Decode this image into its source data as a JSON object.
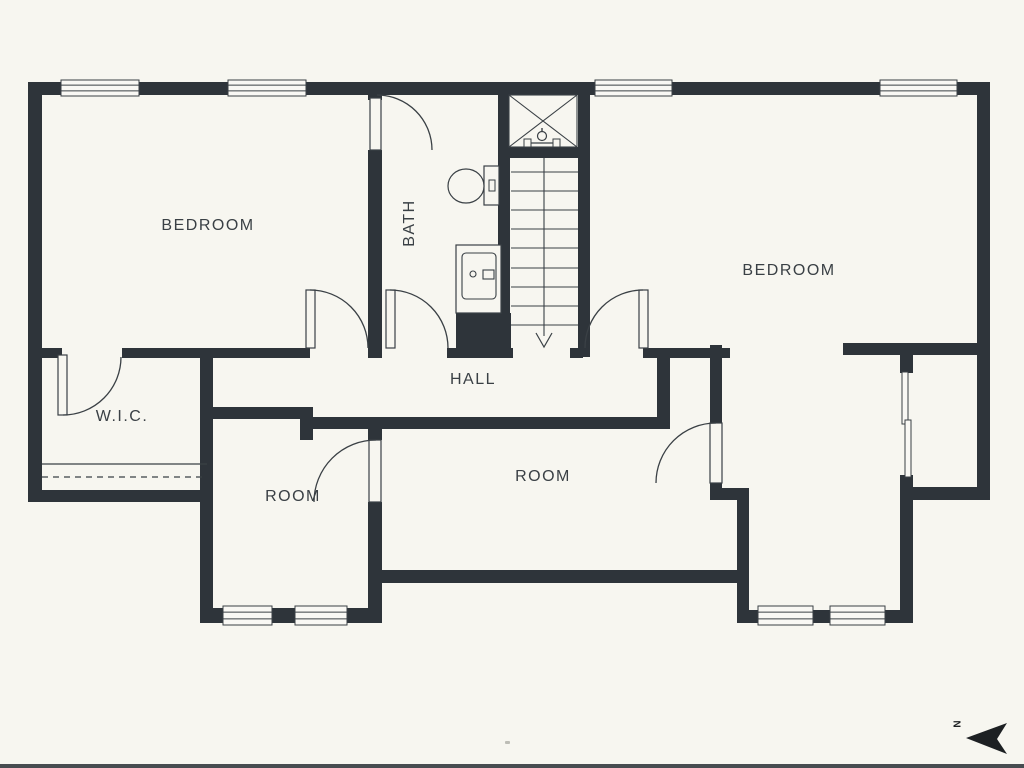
{
  "title": "Floor plan - upper level",
  "colors": {
    "background": "#f7f6f0",
    "wall": "#2e343a",
    "line": "#3a4045",
    "white": "#f9f8f4",
    "arrow": "#1d2023"
  },
  "labels": [
    {
      "text": "BEDROOM",
      "x": 208,
      "y": 226,
      "rotate": 0
    },
    {
      "text": "BATH",
      "x": 410,
      "y": 223,
      "rotate": -90
    },
    {
      "text": "BEDROOM",
      "x": 789,
      "y": 271,
      "rotate": 0
    },
    {
      "text": "W.I.C.",
      "x": 122,
      "y": 417,
      "rotate": 0
    },
    {
      "text": "HALL",
      "x": 473,
      "y": 380,
      "rotate": 0
    },
    {
      "text": "ROOM",
      "x": 293,
      "y": 497,
      "rotate": 0
    },
    {
      "text": "ROOM",
      "x": 543,
      "y": 477,
      "rotate": 0
    }
  ],
  "north": {
    "label": "N",
    "points": "966,738 1007,723 997,739 1007,754",
    "label_x": 958,
    "label_y": 724
  },
  "walls": [
    [
      28,
      82,
      962,
      13
    ],
    [
      28,
      82,
      14,
      420
    ],
    [
      28,
      490,
      185,
      12
    ],
    [
      977,
      82,
      13,
      418
    ],
    [
      903,
      487,
      87,
      13
    ],
    [
      42,
      348,
      20,
      10
    ],
    [
      122,
      348,
      188,
      10
    ],
    [
      447,
      348,
      66,
      10
    ],
    [
      570,
      348,
      13,
      10
    ],
    [
      643,
      348,
      87,
      10
    ],
    [
      843,
      343,
      147,
      12
    ],
    [
      368,
      92,
      14,
      8
    ],
    [
      368,
      150,
      14,
      208
    ],
    [
      498,
      92,
      12,
      265
    ],
    [
      498,
      147,
      92,
      11
    ],
    [
      578,
      95,
      12,
      262
    ],
    [
      456,
      313,
      57,
      44
    ],
    [
      200,
      348,
      13,
      275
    ],
    [
      213,
      407,
      100,
      12
    ],
    [
      300,
      407,
      13,
      33
    ],
    [
      300,
      417,
      370,
      12
    ],
    [
      657,
      348,
      13,
      81
    ],
    [
      368,
      427,
      14,
      13
    ],
    [
      368,
      502,
      14,
      121
    ],
    [
      200,
      608,
      182,
      15
    ],
    [
      368,
      570,
      380,
      13
    ],
    [
      710,
      345,
      12,
      78
    ],
    [
      710,
      483,
      12,
      17
    ],
    [
      710,
      488,
      38,
      12
    ],
    [
      737,
      488,
      12,
      122
    ],
    [
      737,
      610,
      176,
      13
    ],
    [
      900,
      500,
      13,
      123
    ],
    [
      900,
      343,
      13,
      30
    ],
    [
      900,
      475,
      13,
      25
    ]
  ],
  "windows": [
    [
      61,
      80,
      78,
      16
    ],
    [
      228,
      80,
      78,
      16
    ],
    [
      595,
      80,
      77,
      16
    ],
    [
      880,
      80,
      77,
      16
    ],
    [
      223,
      606,
      49,
      19
    ],
    [
      295,
      606,
      52,
      19
    ],
    [
      758,
      606,
      55,
      19
    ],
    [
      830,
      606,
      55,
      19
    ]
  ],
  "door_leaves": [
    [
      58,
      355,
      9,
      60
    ],
    [
      306,
      290,
      9,
      58
    ],
    [
      386,
      290,
      9,
      58
    ],
    [
      639,
      290,
      9,
      58
    ],
    [
      370,
      98,
      11,
      52
    ],
    [
      369,
      440,
      12,
      62
    ],
    [
      710,
      423,
      12,
      60
    ]
  ],
  "door_arcs": [
    {
      "x1": 121,
      "y1": 357,
      "x2": 63,
      "y2": 415,
      "r": 58,
      "sweep": 1
    },
    {
      "x1": 310,
      "y1": 290,
      "x2": 368,
      "y2": 348,
      "r": 58,
      "sweep": 1
    },
    {
      "x1": 390,
      "y1": 290,
      "x2": 448,
      "y2": 348,
      "r": 58,
      "sweep": 1
    },
    {
      "x1": 585,
      "y1": 348,
      "x2": 643,
      "y2": 290,
      "r": 58,
      "sweep": 1
    },
    {
      "x1": 377,
      "y1": 95,
      "x2": 432,
      "y2": 150,
      "r": 55,
      "sweep": 1
    },
    {
      "x1": 376,
      "y1": 440,
      "x2": 314,
      "y2": 502,
      "r": 62,
      "sweep": 0
    },
    {
      "x1": 716,
      "y1": 423,
      "x2": 656,
      "y2": 483,
      "r": 60,
      "sweep": 0
    }
  ],
  "stairs": {
    "x": 511,
    "y": 158,
    "w": 67,
    "h": 190,
    "treads": [
      172,
      191,
      210,
      229,
      248,
      268,
      287,
      306,
      325
    ],
    "rail_x": 544,
    "rail_y1": 158,
    "rail_y2": 336,
    "arrow": {
      "tip_x": 544,
      "tip_y": 347,
      "half": 8,
      "back_y": 333
    }
  },
  "shower": {
    "x": 509,
    "y": 95,
    "w": 68,
    "h": 52,
    "fixture": {
      "cx": 542,
      "cy": 136,
      "bar_x1": 526,
      "bar_x2": 558,
      "bar_y": 143
    }
  },
  "toilet": {
    "bowl": {
      "cx": 466,
      "cy": 186,
      "rx": 18,
      "ry": 17
    },
    "tank": [
      484,
      166,
      15,
      39
    ],
    "button": [
      489,
      180,
      6,
      11
    ]
  },
  "sink": {
    "outer": [
      456,
      245,
      45,
      68
    ],
    "inner": [
      462,
      253,
      34,
      46
    ],
    "dot": {
      "cx": 473,
      "cy": 274,
      "r": 3
    },
    "rect": [
      483,
      270,
      11,
      9
    ]
  },
  "closet_rod": {
    "x1": 42,
    "x2": 207,
    "y_solid": 464,
    "y_dash": 477
  },
  "sliding_panels": [
    [
      902,
      372,
      6,
      52
    ],
    [
      905,
      420,
      6,
      57
    ]
  ],
  "dot": {
    "x": 505,
    "y": 741,
    "w": 5,
    "h": 3
  },
  "bottom_border": {
    "h": 4
  }
}
